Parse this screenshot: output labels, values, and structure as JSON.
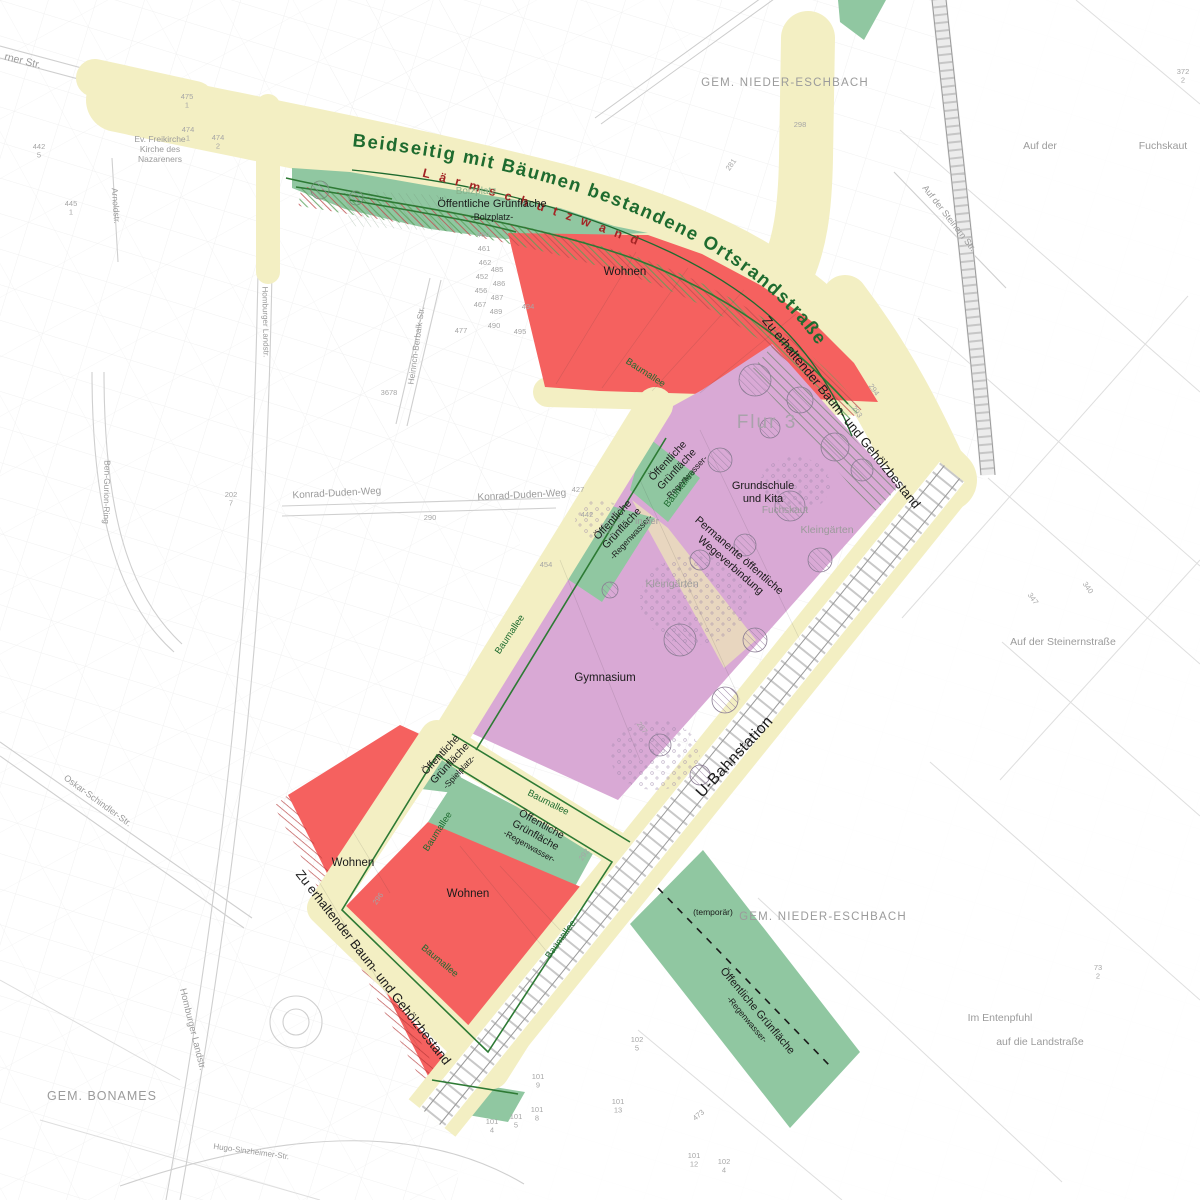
{
  "curved": {
    "road_title": "Beidseitig mit Bäumen bestandene Ortsrandstraße",
    "noise_wall": "Lärmschutzwand"
  },
  "colors": {
    "road": "#f3efc3",
    "residential": "#f5615f",
    "school_area": "#d9a9d5",
    "green": "#90c7a1",
    "green_dark": "#2d7a34",
    "path_tan": "#e8d6bf",
    "title_green": "#1e6b2f",
    "noise_text": "#a32525",
    "gray_label": "#9b9b9b",
    "rail_tick": "#c2c2c2"
  },
  "labels": [
    {
      "id": "gem-nieder-eschbach-top",
      "t": "GEM. NIEDER-ESCHBACH",
      "x": 785,
      "y": 86,
      "s": 11.5,
      "cls": "gray",
      "ls": 1.2
    },
    {
      "id": "gem-nieder-eschbach-bottom",
      "t": "GEM. NIEDER-ESCHBACH",
      "x": 823,
      "y": 920,
      "s": 11.5,
      "cls": "gray",
      "ls": 1.2
    },
    {
      "id": "gem-bonames",
      "t": "GEM. BONAMES",
      "x": 102,
      "y": 1100,
      "s": 12.5,
      "cls": "gray",
      "ls": 1
    },
    {
      "id": "flur-3",
      "t": "Flur 3",
      "x": 767,
      "y": 428,
      "s": 19,
      "cls": "flur",
      "ls": 2
    },
    {
      "id": "wohnen-top",
      "t": "Wohnen",
      "x": 625,
      "y": 275,
      "s": 11.5,
      "cls": "black"
    },
    {
      "id": "wohnen-left",
      "t": "Wohnen",
      "x": 353,
      "y": 866,
      "s": 11.5,
      "cls": "black"
    },
    {
      "id": "wohnen-inner",
      "t": "Wohnen",
      "x": 468,
      "y": 897,
      "s": 11.5,
      "cls": "black"
    },
    {
      "id": "gymnasium",
      "t": "Gymnasium",
      "x": 605,
      "y": 681,
      "s": 11.5,
      "cls": "black"
    },
    {
      "id": "grundschule-kita",
      "lines": [
        "Grundschule",
        "und Kita"
      ],
      "x": 763,
      "y": 489,
      "s": 11,
      "cls": "black"
    },
    {
      "id": "og-bolzplatz",
      "lines": [
        "Öffentliche Grünfläche",
        {
          "t": "-Bolzplatz-",
          "s": 9
        }
      ],
      "x": 492,
      "y": 207,
      "s": 11,
      "cls": "black"
    },
    {
      "id": "bolzplatz-historic",
      "t": "Bolzplatz",
      "x": 476,
      "y": 194,
      "s": 10,
      "cls": "ltgreen"
    },
    {
      "id": "og-regenwasser-1",
      "lines": [
        "Öffentliche",
        "Grünfläche",
        {
          "t": "-Regenwasser-",
          "s": 8.5
        }
      ],
      "x": 670,
      "y": 463,
      "s": 10.5,
      "cls": "black",
      "rot": -47
    },
    {
      "id": "og-regenwasser-2",
      "lines": [
        "Öffentliche",
        "Grünfläche",
        {
          "t": "-Regenwasser-",
          "s": 8.5
        }
      ],
      "x": 615,
      "y": 522,
      "s": 10.5,
      "cls": "black",
      "rot": -47
    },
    {
      "id": "og-spielplatz",
      "lines": [
        "Öffentliche",
        "Grünfläche",
        {
          "t": "-Spielplatz-",
          "s": 8.5
        }
      ],
      "x": 443,
      "y": 757,
      "s": 10.5,
      "cls": "black",
      "rot": -47
    },
    {
      "id": "og-regenwasser-3",
      "lines": [
        "Öffentliche",
        "Grünfläche",
        {
          "t": "-Regenwasser-",
          "s": 8.5
        }
      ],
      "x": 540,
      "y": 827,
      "s": 10.5,
      "cls": "black",
      "rot": 29
    },
    {
      "id": "og-regenwasser-4",
      "lines": [
        "Öffentliche Grünfläche",
        {
          "t": "-Regenwasser-",
          "s": 8.5
        }
      ],
      "x": 755,
      "y": 1013,
      "s": 11,
      "cls": "black",
      "rot": 50
    },
    {
      "id": "temporaer",
      "t": "(temporär)",
      "x": 713,
      "y": 915,
      "s": 8.5,
      "cls": "black"
    },
    {
      "id": "baumallee-1",
      "t": "Baumallee",
      "x": 644,
      "y": 375,
      "s": 9.5,
      "cls": "green",
      "rot": 33
    },
    {
      "id": "baumallee-2",
      "t": "Baumallee",
      "x": 682,
      "y": 490,
      "s": 9.5,
      "cls": "green",
      "rot": -52
    },
    {
      "id": "baumallee-3",
      "t": "Baumallee",
      "x": 512,
      "y": 636,
      "s": 9.5,
      "cls": "green",
      "rot": -56
    },
    {
      "id": "baumallee-4",
      "t": "Baumallee",
      "x": 547,
      "y": 805,
      "s": 9.5,
      "cls": "green",
      "rot": 27
    },
    {
      "id": "baumallee-5",
      "t": "Baumallee",
      "x": 440,
      "y": 833,
      "s": 9.5,
      "cls": "green",
      "rot": -57
    },
    {
      "id": "baumallee-6",
      "t": "Baumallee",
      "x": 563,
      "y": 941,
      "s": 9.5,
      "cls": "green",
      "rot": -54
    },
    {
      "id": "baumallee-7",
      "t": "Baumallee",
      "x": 438,
      "y": 963,
      "s": 9.5,
      "cls": "green",
      "rot": 40
    },
    {
      "id": "zu-erhaltender-right",
      "t": "Zu erhaltender Baum- und Gehölzbestand",
      "x": 838,
      "y": 415,
      "s": 13,
      "cls": "black",
      "rot": 51
    },
    {
      "id": "zu-erhaltender-left",
      "t": "Zu erhaltender Baum- und Gehölzbestand",
      "x": 370,
      "y": 970,
      "s": 13,
      "cls": "black",
      "rot": 52
    },
    {
      "id": "permanente-wegeverbindung",
      "lines": [
        "Permanente öffentliche",
        "Wegeverbindung"
      ],
      "x": 737,
      "y": 558,
      "s": 11,
      "cls": "black",
      "rot": 41
    },
    {
      "id": "u-bahnstation",
      "t": "U-Bahnstation",
      "x": 738,
      "y": 760,
      "s": 15.5,
      "cls": "black",
      "rot": -47,
      "ls": 0.5
    },
    {
      "id": "fuchskaut-flur",
      "t": "Fuchskaut",
      "x": 785,
      "y": 513,
      "s": 10,
      "cls": "gray"
    },
    {
      "id": "kleingaerten-1",
      "t": "Kleingärten",
      "x": 827,
      "y": 533,
      "s": 10.5,
      "cls": "gray"
    },
    {
      "id": "kleingaerten-2",
      "t": "Kleingärten",
      "x": 672,
      "y": 587,
      "s": 10.5,
      "cls": "gray"
    },
    {
      "id": "in-der",
      "t": "in der",
      "x": 647,
      "y": 524,
      "s": 9.5,
      "cls": "gray"
    },
    {
      "id": "konrad-duden-weg-1",
      "t": "Konrad-Duden-Weg",
      "x": 337,
      "y": 496,
      "s": 10,
      "cls": "gray",
      "rot": -3
    },
    {
      "id": "konrad-duden-weg-2",
      "t": "Konrad-Duden-Weg",
      "x": 522,
      "y": 498,
      "s": 10,
      "cls": "gray",
      "rot": -3
    },
    {
      "id": "auf-der",
      "t": "Auf der",
      "x": 1040,
      "y": 149,
      "s": 10.5,
      "cls": "gray"
    },
    {
      "id": "fuchskaut-ne",
      "t": "Fuchskaut",
      "x": 1163,
      "y": 149,
      "s": 10.5,
      "cls": "gray"
    },
    {
      "id": "auf-der-steinern-str",
      "t": "Auf der Steinern Str.",
      "x": 947,
      "y": 220,
      "s": 9,
      "cls": "gray",
      "rot": 52
    },
    {
      "id": "auf-der-steinernstrasse",
      "t": "Auf der Steinernstraße",
      "x": 1063,
      "y": 645,
      "s": 10.5,
      "cls": "gray"
    },
    {
      "id": "im-entenpfuhl",
      "t": "Im Entenpfuhl",
      "x": 1000,
      "y": 1021,
      "s": 10.5,
      "cls": "gray"
    },
    {
      "id": "auf-die-landstrasse",
      "t": "auf die Landstraße",
      "x": 1040,
      "y": 1045,
      "s": 10.5,
      "cls": "gray"
    },
    {
      "id": "berner-str",
      "t": "rner Str.",
      "x": 22,
      "y": 64,
      "s": 10.5,
      "cls": "gray",
      "rot": 14
    },
    {
      "id": "ev-kirche",
      "lines": [
        "Ev. Freikirche",
        "Kirche des",
        "Nazareners"
      ],
      "x": 160,
      "y": 142,
      "s": 8.5,
      "cls": "gray"
    },
    {
      "id": "homburger-landstr-n",
      "t": "Homburger Landstr.",
      "x": 263,
      "y": 322,
      "s": 8,
      "cls": "gray",
      "rot": 89
    },
    {
      "id": "homburger-landstr-s",
      "t": "Homburger Landstr.",
      "x": 190,
      "y": 1030,
      "s": 9.5,
      "cls": "gray",
      "rot": 76
    },
    {
      "id": "ben-gurion-ring",
      "t": "Ben-Gurion-Ring",
      "x": 104,
      "y": 492,
      "s": 8.5,
      "cls": "gray",
      "rot": 91
    },
    {
      "id": "oskar-schindler-str",
      "t": "Oskar-Schindler-Str.",
      "x": 96,
      "y": 803,
      "s": 9,
      "cls": "gray",
      "rot": 36
    },
    {
      "id": "heinrich-berbalk-str",
      "t": "Heinrich-Berbalk-Str.",
      "x": 419,
      "y": 346,
      "s": 8.5,
      "cls": "gray",
      "rot": -82
    },
    {
      "id": "arnoldstr",
      "t": "Arnoldstr.",
      "x": 113,
      "y": 206,
      "s": 8.5,
      "cls": "gray",
      "rot": 86
    },
    {
      "id": "hugo-sinzheimer-str",
      "t": "Hugo-Sinzheimer-Str.",
      "x": 251,
      "y": 1154,
      "s": 8,
      "cls": "gray",
      "rot": 8
    }
  ],
  "parcel_numbers": [
    {
      "t": "427",
      "x": 578,
      "y": 492
    },
    {
      "t": "442",
      "x": 587,
      "y": 517
    },
    {
      "t": "454",
      "x": 546,
      "y": 567
    },
    {
      "t": "3678",
      "x": 389,
      "y": 395
    },
    {
      "t": "202/7",
      "x": 231,
      "y": 497,
      "st": true
    },
    {
      "t": "281",
      "x": 733,
      "y": 166,
      "rot": -55
    },
    {
      "t": "294",
      "x": 872,
      "y": 391,
      "rot": 55
    },
    {
      "t": "293",
      "x": 855,
      "y": 413,
      "rot": 55
    },
    {
      "t": "287",
      "x": 640,
      "y": 729,
      "rot": 55
    },
    {
      "t": "292",
      "x": 586,
      "y": 856,
      "rot": -55
    },
    {
      "t": "372/2",
      "x": 1183,
      "y": 74,
      "st": true
    },
    {
      "t": "73/2",
      "x": 1098,
      "y": 970,
      "st": true
    },
    {
      "t": "340",
      "x": 1086,
      "y": 589,
      "rot": 55
    },
    {
      "t": "347",
      "x": 1031,
      "y": 600,
      "rot": 55
    },
    {
      "t": "101/9",
      "x": 538,
      "y": 1079,
      "st": true
    },
    {
      "t": "101/13",
      "x": 618,
      "y": 1104,
      "st": true
    },
    {
      "t": "102/5",
      "x": 637,
      "y": 1042,
      "st": true
    },
    {
      "t": "101/8",
      "x": 537,
      "y": 1112,
      "st": true
    },
    {
      "t": "101/5",
      "x": 516,
      "y": 1119,
      "st": true
    },
    {
      "t": "101/4",
      "x": 492,
      "y": 1124,
      "st": true
    },
    {
      "t": "101/12",
      "x": 694,
      "y": 1158,
      "st": true
    },
    {
      "t": "102/4",
      "x": 724,
      "y": 1164,
      "st": true
    },
    {
      "t": "473",
      "x": 700,
      "y": 1117,
      "rot": -40
    },
    {
      "t": "460",
      "x": 483,
      "y": 237
    },
    {
      "t": "461",
      "x": 484,
      "y": 251
    },
    {
      "t": "462",
      "x": 485,
      "y": 265
    },
    {
      "t": "452",
      "x": 482,
      "y": 279
    },
    {
      "t": "456",
      "x": 481,
      "y": 293
    },
    {
      "t": "467",
      "x": 480,
      "y": 307
    },
    {
      "t": "477",
      "x": 461,
      "y": 333
    },
    {
      "t": "485",
      "x": 497,
      "y": 272
    },
    {
      "t": "486",
      "x": 499,
      "y": 286
    },
    {
      "t": "487",
      "x": 497,
      "y": 300
    },
    {
      "t": "489",
      "x": 496,
      "y": 314
    },
    {
      "t": "490",
      "x": 494,
      "y": 328
    },
    {
      "t": "494",
      "x": 528,
      "y": 309
    },
    {
      "t": "495",
      "x": 520,
      "y": 334
    },
    {
      "t": "474/1",
      "x": 188,
      "y": 132,
      "st": true
    },
    {
      "t": "474/2",
      "x": 218,
      "y": 140,
      "st": true
    },
    {
      "t": "475/1",
      "x": 187,
      "y": 99,
      "st": true
    },
    {
      "t": "445/1",
      "x": 71,
      "y": 206,
      "st": true
    },
    {
      "t": "442/5",
      "x": 39,
      "y": 149,
      "st": true
    },
    {
      "t": "296",
      "x": 380,
      "y": 900,
      "rot": -55
    },
    {
      "t": "290",
      "x": 430,
      "y": 520
    },
    {
      "t": "298",
      "x": 800,
      "y": 127,
      "st": false
    }
  ]
}
